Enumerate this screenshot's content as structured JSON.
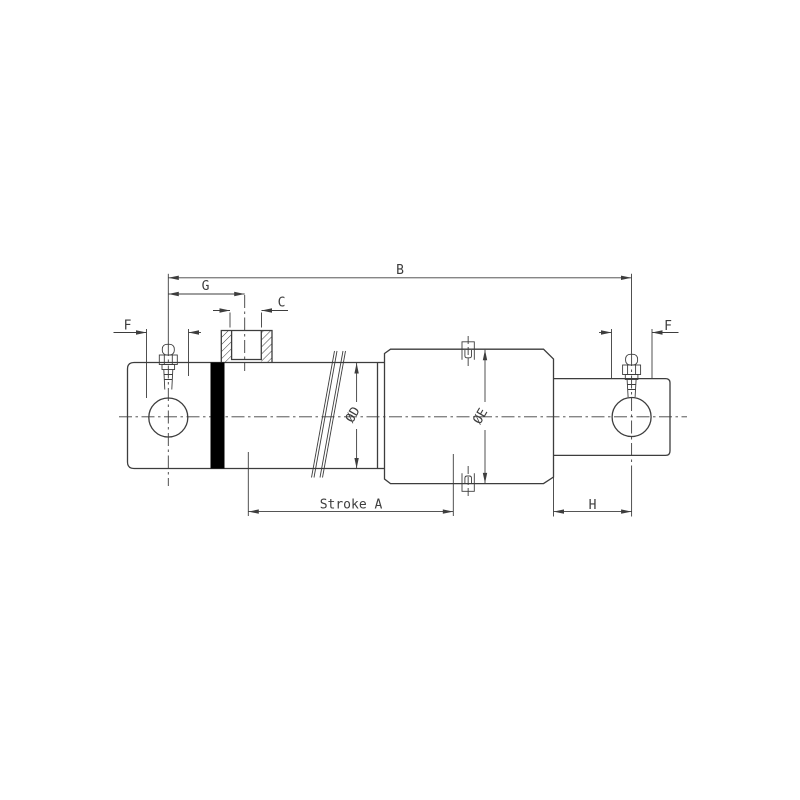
{
  "drawing": {
    "type": "hydraulic-cylinder-dimension-drawing",
    "labels": {
      "overall_length": "B",
      "port_position": "G",
      "port_size": "C",
      "eye_bore_left": "F",
      "eye_bore_right": "F",
      "tube_diameter": "ØD",
      "body_diameter": "ØE",
      "stroke": "Stroke A",
      "rod_end_distance": "H"
    },
    "colors": {
      "line": "#3d3d3d",
      "weld_band": "#000000",
      "background": "#ffffff"
    }
  }
}
